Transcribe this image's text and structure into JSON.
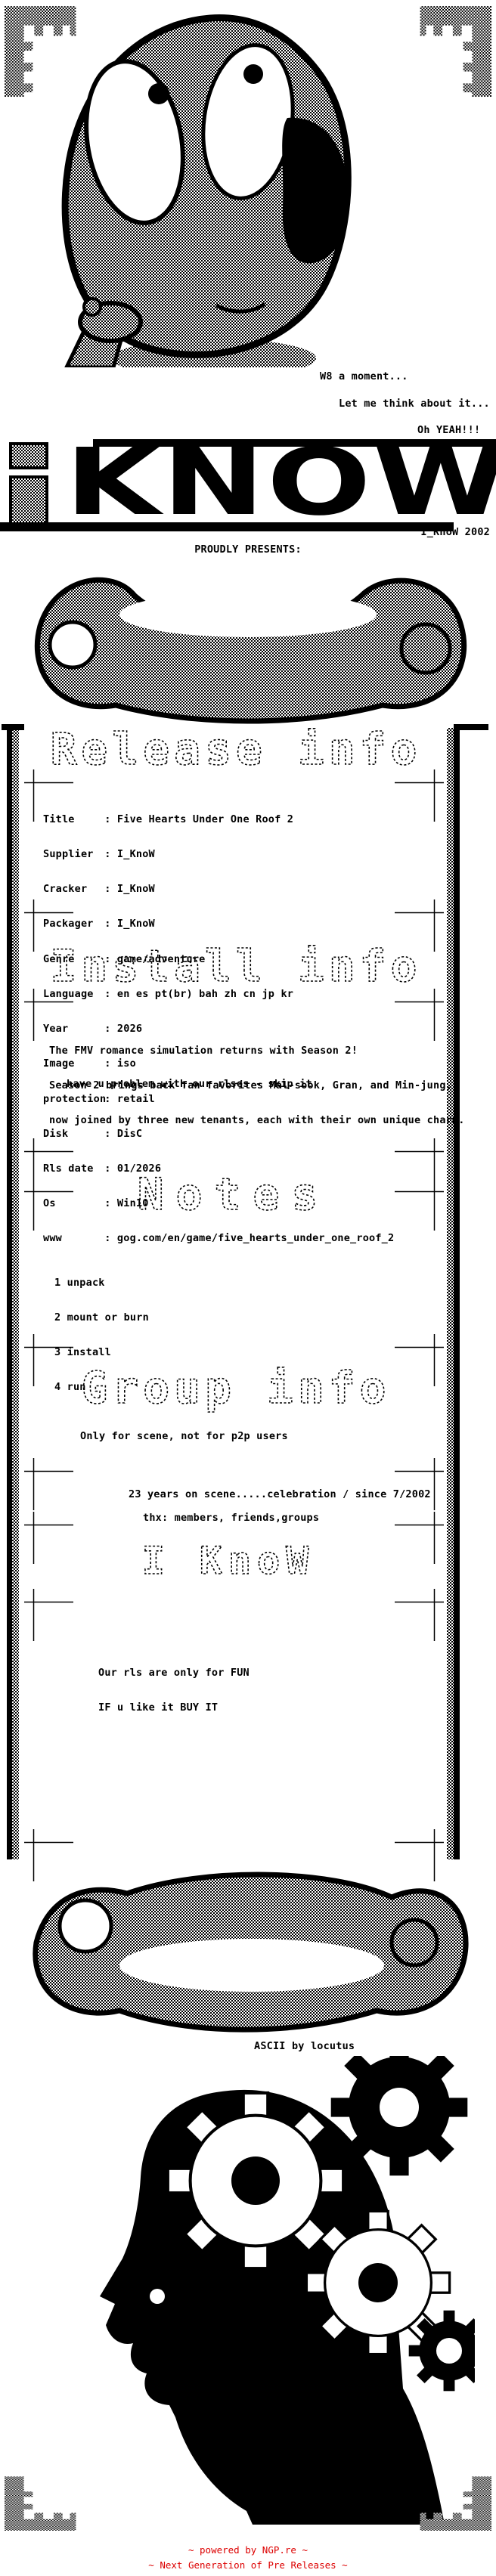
{
  "page": {
    "background": "#ffffff",
    "ink": "#000000"
  },
  "intro": {
    "thought_lines": [
      "W8 a moment...",
      "Let me think about it...",
      "Oh YEAH!!!"
    ]
  },
  "logo": {
    "letter_i": "i",
    "word": "KNOW",
    "credit": "I_KnoW 2002",
    "presents": "PROUDLY PRESENTS:"
  },
  "sections": {
    "release": {
      "header": "Release info",
      "separator": ": ",
      "fields": [
        {
          "label": "Title",
          "value": "Five Hearts Under One Roof 2"
        },
        {
          "label": "Supplier",
          "value": "I_KnoW"
        },
        {
          "label": "Cracker",
          "value": "I_KnoW"
        },
        {
          "label": "Packager",
          "value": "I_KnoW"
        },
        {
          "label": "Genre",
          "value": "game/adventure"
        },
        {
          "label": "Language",
          "value": "en es pt(br) bah zh cn jp kr"
        },
        {
          "label": "Year",
          "value": "2026"
        },
        {
          "label": "Image",
          "value": "iso"
        },
        {
          "label": "protection",
          "value": "retail"
        },
        {
          "label": "Disk",
          "value": "DisC"
        },
        {
          "label": "Rls date",
          "value": "01/2026"
        },
        {
          "label": "Os",
          "value": "Win10"
        },
        {
          "label": "www",
          "value": "gog.com/en/game/five_hearts_under_one_roof_2"
        }
      ]
    },
    "install": {
      "header": "Install info",
      "lines": [
        "The FMV romance simulation returns with Season 2!",
        "Season 2 brings back fan favorites Mal-sook, Gran, and Min-jung,",
        "now joined by three new tenants, each with their own unique charm."
      ],
      "note": "have u problem with our rlses - skip it"
    },
    "notes": {
      "header": "Notes",
      "items": [
        "1 unpack",
        "2 mount or burn",
        "3 install",
        "4 run"
      ]
    },
    "group": {
      "header": "Group info",
      "lines": [
        "Only for scene, not for p2p users",
        "23 years on scene.....celebration / since 7/2002",
        "thx: members, friends,groups"
      ]
    },
    "iknow": {
      "header": "I KnoW",
      "lines": [
        "Our rls are only for FUN",
        "IF u like it BUY IT"
      ]
    }
  },
  "credits": {
    "ascii_by": "ASCII by locutus"
  },
  "footer": {
    "line1": "~ powered by NGP.re ~",
    "line2": "~ Next Generation of Pre Releases ~",
    "color": "#dd0000"
  },
  "art": {
    "alien": "alien-thinking-art",
    "scroll_top": "scroll-top-art",
    "scroll_bottom": "scroll-bottom-art",
    "head_gears": "head-with-gears-art",
    "corner": "checker-battlement-ornament"
  }
}
